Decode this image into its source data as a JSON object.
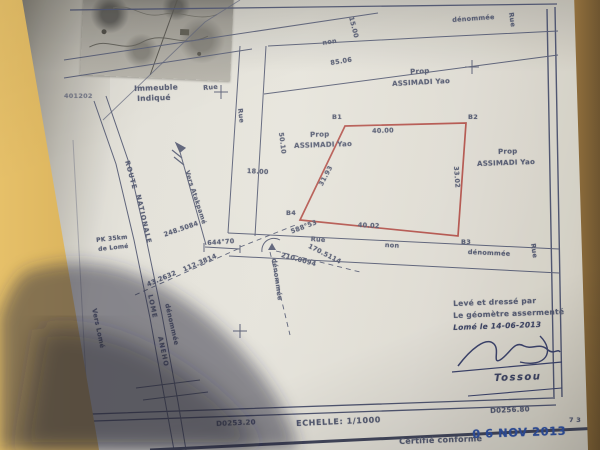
{
  "plan": {
    "colors": {
      "ink": "#535970",
      "parcel_red": "#a8423c",
      "stamp_blue": "#2d4fa1",
      "table": "#cfa85c"
    },
    "inset_caption": {
      "line1": "Immeuble",
      "line2": "Indiqué"
    },
    "margin_ref": "401202",
    "street": {
      "rue": "Rue",
      "non": "non",
      "denommee": "dénommée"
    },
    "route": {
      "w1": "ROUTE",
      "w2": "NATIONALE",
      "w3": "LOME",
      "w4": "ANEHO"
    },
    "pk": {
      "line1": "PK 35km",
      "line2": "de Lomé"
    },
    "directions": {
      "atakpame": "Vers Atakpamé",
      "lome": "Vers Lomé"
    },
    "owners": {
      "prop": "Prop",
      "name": "ASSIMADI Yao"
    },
    "parcel": {
      "b1": "B1",
      "b2": "B2",
      "b3": "B3",
      "b4": "B4",
      "top": "40.00",
      "bottom": "40.02",
      "left": "31.93",
      "right": "33.02"
    },
    "dims": {
      "road_width": "15.00",
      "frontage": "85.06",
      "rue_width": "18.00",
      "side": "50.10"
    },
    "survey": {
      "p1": "248.5084",
      "p2": "644°70",
      "p3": "588°53",
      "p4": "170.5114",
      "p5": "210.0094",
      "p6": "43.2632",
      "p7": "112.3814"
    },
    "footer": {
      "coord_left": "D0253.20",
      "scale": "ECHELLE: 1/1000",
      "coord_right": "D0256.80",
      "page": "7 3",
      "certify": "Certifié conforme",
      "stamp_date": "0 6 NOV 2013"
    },
    "cartouche": {
      "line1": "Levé et dressé par",
      "line2": "Le géomètre assermenté",
      "line3": "Lomé le 14-06-2013",
      "name": "Tossou"
    }
  }
}
